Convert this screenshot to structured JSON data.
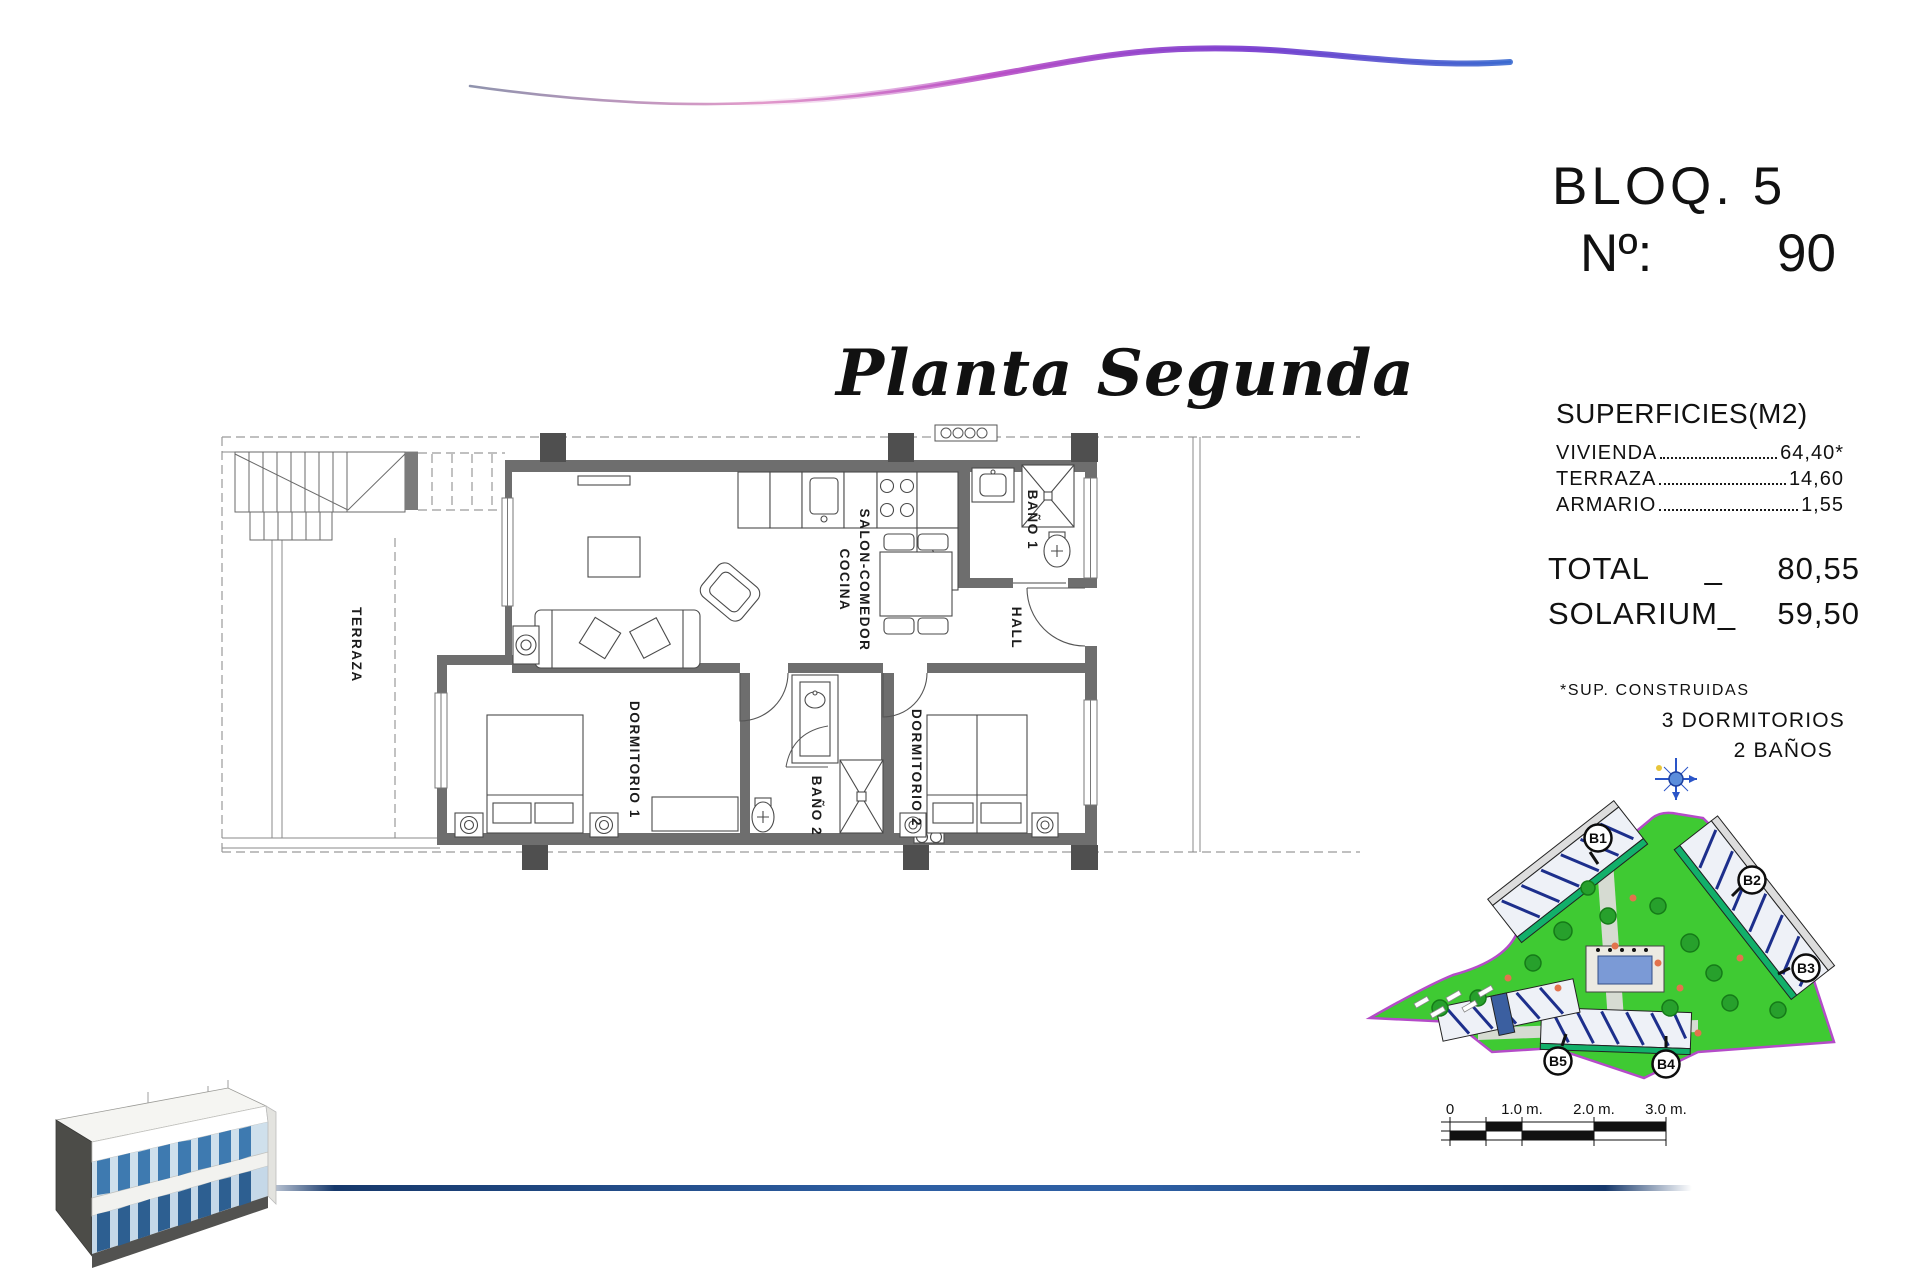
{
  "header": {
    "block": "BLOQ. 5",
    "num_label": "Nº:",
    "num_value": "90"
  },
  "title": {
    "text": "Planta Segunda"
  },
  "surfaces": {
    "heading": "SUPERFICIES(M2)",
    "rows": [
      {
        "label": "VIVIENDA",
        "value": "64,40*"
      },
      {
        "label": "TERRAZA",
        "value": "14,60"
      },
      {
        "label": "ARMARIO",
        "value": "1,55"
      }
    ],
    "total_label": "TOTAL",
    "total_sep": "_",
    "total_value": "80,55",
    "solarium_label": "SOLARIUM_",
    "solarium_value": "59,50",
    "footnote": "*SUP. CONSTRUIDAS",
    "bedrooms": "3 DORMITORIOS",
    "bathrooms": "2 BAÑOS"
  },
  "plan": {
    "rooms": {
      "terraza": "TERRAZA",
      "salon_line1": "SALON-COMEDOR",
      "salon_line2": "COCINA",
      "bano1": "BAÑO 1",
      "hall": "HALL",
      "dormitorio1": "DORMITORIO 1",
      "bano2": "BAÑO 2",
      "dormitorio2": "DORMITORIO 2"
    }
  },
  "site_plan": {
    "labels": [
      "B1",
      "B2",
      "B3",
      "B4",
      "B5"
    ]
  },
  "scale_bar": {
    "t0": "0",
    "t1": "1.0 m.",
    "t2": "2.0 m.",
    "t3": "3.0 m."
  },
  "colors": {
    "wall": "#6e6e6e",
    "pillar": "#4f4f4f",
    "site_green": "#3fca33",
    "site_boundary": "#b44bc8",
    "pool_blue": "#7b9ad6",
    "building_hatch": "#1d2f8c",
    "bottom_line_blue": "#2e5fa3",
    "wave_pink": "#e39bcb",
    "wave_magenta": "#b94fc6",
    "wave_purple": "#7c3fd0",
    "wave_blue": "#3a6ad0"
  }
}
